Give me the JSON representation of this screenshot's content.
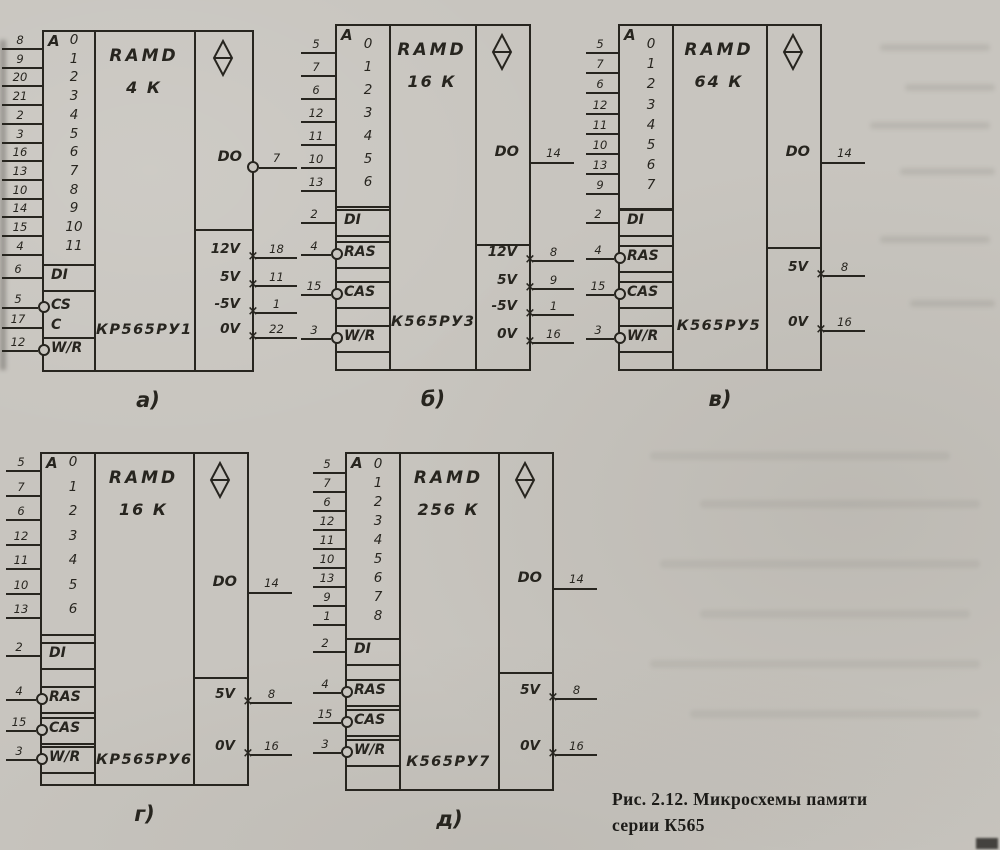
{
  "figure": {
    "caption_line1": "Рис. 2.12. Микросхемы памяти",
    "caption_line2": "серии К565"
  },
  "symbols": {
    "ram_qualifier_icon": "diamond-with-bar",
    "power_pin_marker": "×"
  },
  "colors": {
    "paper": "#c8c5bf",
    "ink": "#27251f"
  },
  "chips": [
    {
      "id": "a",
      "sublabel": "а)",
      "part": "КР565РУ1",
      "type_lines": [
        "RAMD",
        "4 К"
      ],
      "addr_header": "A",
      "addr_pins": [
        {
          "pin": "8",
          "bit": "0"
        },
        {
          "pin": "9",
          "bit": "1"
        },
        {
          "pin": "20",
          "bit": "2"
        },
        {
          "pin": "21",
          "bit": "3"
        },
        {
          "pin": "2",
          "bit": "4"
        },
        {
          "pin": "3",
          "bit": "5"
        },
        {
          "pin": "16",
          "bit": "6"
        },
        {
          "pin": "13",
          "bit": "7"
        },
        {
          "pin": "10",
          "bit": "8"
        },
        {
          "pin": "14",
          "bit": "9"
        },
        {
          "pin": "15",
          "bit": "10"
        },
        {
          "pin": "4",
          "bit": "11"
        }
      ],
      "controls": [
        {
          "label": "DI",
          "pin": "6",
          "circle": false,
          "lines": "both"
        },
        {
          "label": "CS",
          "pin": "5",
          "circle": true,
          "lines": "none"
        },
        {
          "label": "C",
          "pin": "17",
          "circle": false,
          "lines": "none"
        },
        {
          "label": "W/R",
          "pin": "12",
          "circle": true,
          "lines": "top"
        }
      ],
      "output": {
        "label": "DO",
        "pin": "7",
        "circle": true
      },
      "power": [
        {
          "label": "12V",
          "pin": "18"
        },
        {
          "label": "5V",
          "pin": "11"
        },
        {
          "label": "-5V",
          "pin": "1"
        },
        {
          "label": "0V",
          "pin": "22"
        }
      ]
    },
    {
      "id": "b",
      "sublabel": "б)",
      "part": "К565РУ3",
      "type_lines": [
        "RAMD",
        "16 К"
      ],
      "addr_header": "A",
      "addr_pins": [
        {
          "pin": "5",
          "bit": "0"
        },
        {
          "pin": "7",
          "bit": "1"
        },
        {
          "pin": "6",
          "bit": "2"
        },
        {
          "pin": "12",
          "bit": "3"
        },
        {
          "pin": "11",
          "bit": "4"
        },
        {
          "pin": "10",
          "bit": "5"
        },
        {
          "pin": "13",
          "bit": "6"
        }
      ],
      "controls": [
        {
          "label": "DI",
          "pin": "2",
          "circle": false,
          "lines": "both"
        },
        {
          "label": "RAS",
          "pin": "4",
          "circle": true,
          "lines": "both"
        },
        {
          "label": "CAS",
          "pin": "15",
          "circle": true,
          "lines": "both"
        },
        {
          "label": "W/R",
          "pin": "3",
          "circle": true,
          "lines": "both"
        }
      ],
      "output": {
        "label": "DO",
        "pin": "14",
        "circle": false
      },
      "power": [
        {
          "label": "12V",
          "pin": "8"
        },
        {
          "label": "5V",
          "pin": "9"
        },
        {
          "label": "-5V",
          "pin": "1"
        },
        {
          "label": "0V",
          "pin": "16"
        }
      ]
    },
    {
      "id": "v",
      "sublabel": "в)",
      "part": "К565РУ5",
      "type_lines": [
        "RAMD",
        "64 К"
      ],
      "addr_header": "A",
      "addr_pins": [
        {
          "pin": "5",
          "bit": "0"
        },
        {
          "pin": "7",
          "bit": "1"
        },
        {
          "pin": "6",
          "bit": "2"
        },
        {
          "pin": "12",
          "bit": "3"
        },
        {
          "pin": "11",
          "bit": "4"
        },
        {
          "pin": "10",
          "bit": "5"
        },
        {
          "pin": "13",
          "bit": "6"
        },
        {
          "pin": "9",
          "bit": "7"
        }
      ],
      "controls": [
        {
          "label": "DI",
          "pin": "2",
          "circle": false,
          "lines": "both"
        },
        {
          "label": "RAS",
          "pin": "4",
          "circle": true,
          "lines": "both"
        },
        {
          "label": "CAS",
          "pin": "15",
          "circle": true,
          "lines": "both"
        },
        {
          "label": "W/R",
          "pin": "3",
          "circle": true,
          "lines": "both"
        }
      ],
      "output": {
        "label": "DO",
        "pin": "14",
        "circle": false
      },
      "power": [
        {
          "label": "5V",
          "pin": "8"
        },
        {
          "label": "0V",
          "pin": "16"
        }
      ]
    },
    {
      "id": "g",
      "sublabel": "г)",
      "part": "КР565РУ6",
      "type_lines": [
        "RAMD",
        "16 К"
      ],
      "addr_header": "A",
      "addr_pins": [
        {
          "pin": "5",
          "bit": "0"
        },
        {
          "pin": "7",
          "bit": "1"
        },
        {
          "pin": "6",
          "bit": "2"
        },
        {
          "pin": "12",
          "bit": "3"
        },
        {
          "pin": "11",
          "bit": "4"
        },
        {
          "pin": "10",
          "bit": "5"
        },
        {
          "pin": "13",
          "bit": "6"
        }
      ],
      "controls": [
        {
          "label": "DI",
          "pin": "2",
          "circle": false,
          "lines": "both"
        },
        {
          "label": "RAS",
          "pin": "4",
          "circle": true,
          "lines": "both"
        },
        {
          "label": "CAS",
          "pin": "15",
          "circle": true,
          "lines": "both"
        },
        {
          "label": "W/R",
          "pin": "3",
          "circle": true,
          "lines": "both"
        }
      ],
      "output": {
        "label": "DO",
        "pin": "14",
        "circle": false
      },
      "power": [
        {
          "label": "5V",
          "pin": "8"
        },
        {
          "label": "0V",
          "pin": "16"
        }
      ]
    },
    {
      "id": "d",
      "sublabel": "д)",
      "part": "К565РУ7",
      "type_lines": [
        "RAMD",
        "256 К"
      ],
      "addr_header": "A",
      "addr_pins": [
        {
          "pin": "5",
          "bit": "0"
        },
        {
          "pin": "7",
          "bit": "1"
        },
        {
          "pin": "6",
          "bit": "2"
        },
        {
          "pin": "12",
          "bit": "3"
        },
        {
          "pin": "11",
          "bit": "4"
        },
        {
          "pin": "10",
          "bit": "5"
        },
        {
          "pin": "13",
          "bit": "6"
        },
        {
          "pin": "9",
          "bit": "7"
        },
        {
          "pin": "1",
          "bit": "8"
        }
      ],
      "controls": [
        {
          "label": "DI",
          "pin": "2",
          "circle": false,
          "lines": "both"
        },
        {
          "label": "RAS",
          "pin": "4",
          "circle": true,
          "lines": "both"
        },
        {
          "label": "CAS",
          "pin": "15",
          "circle": true,
          "lines": "both"
        },
        {
          "label": "W/R",
          "pin": "3",
          "circle": true,
          "lines": "both"
        }
      ],
      "output": {
        "label": "DO",
        "pin": "14",
        "circle": false
      },
      "power": [
        {
          "label": "5V",
          "pin": "8"
        },
        {
          "label": "0V",
          "pin": "16"
        }
      ]
    }
  ]
}
